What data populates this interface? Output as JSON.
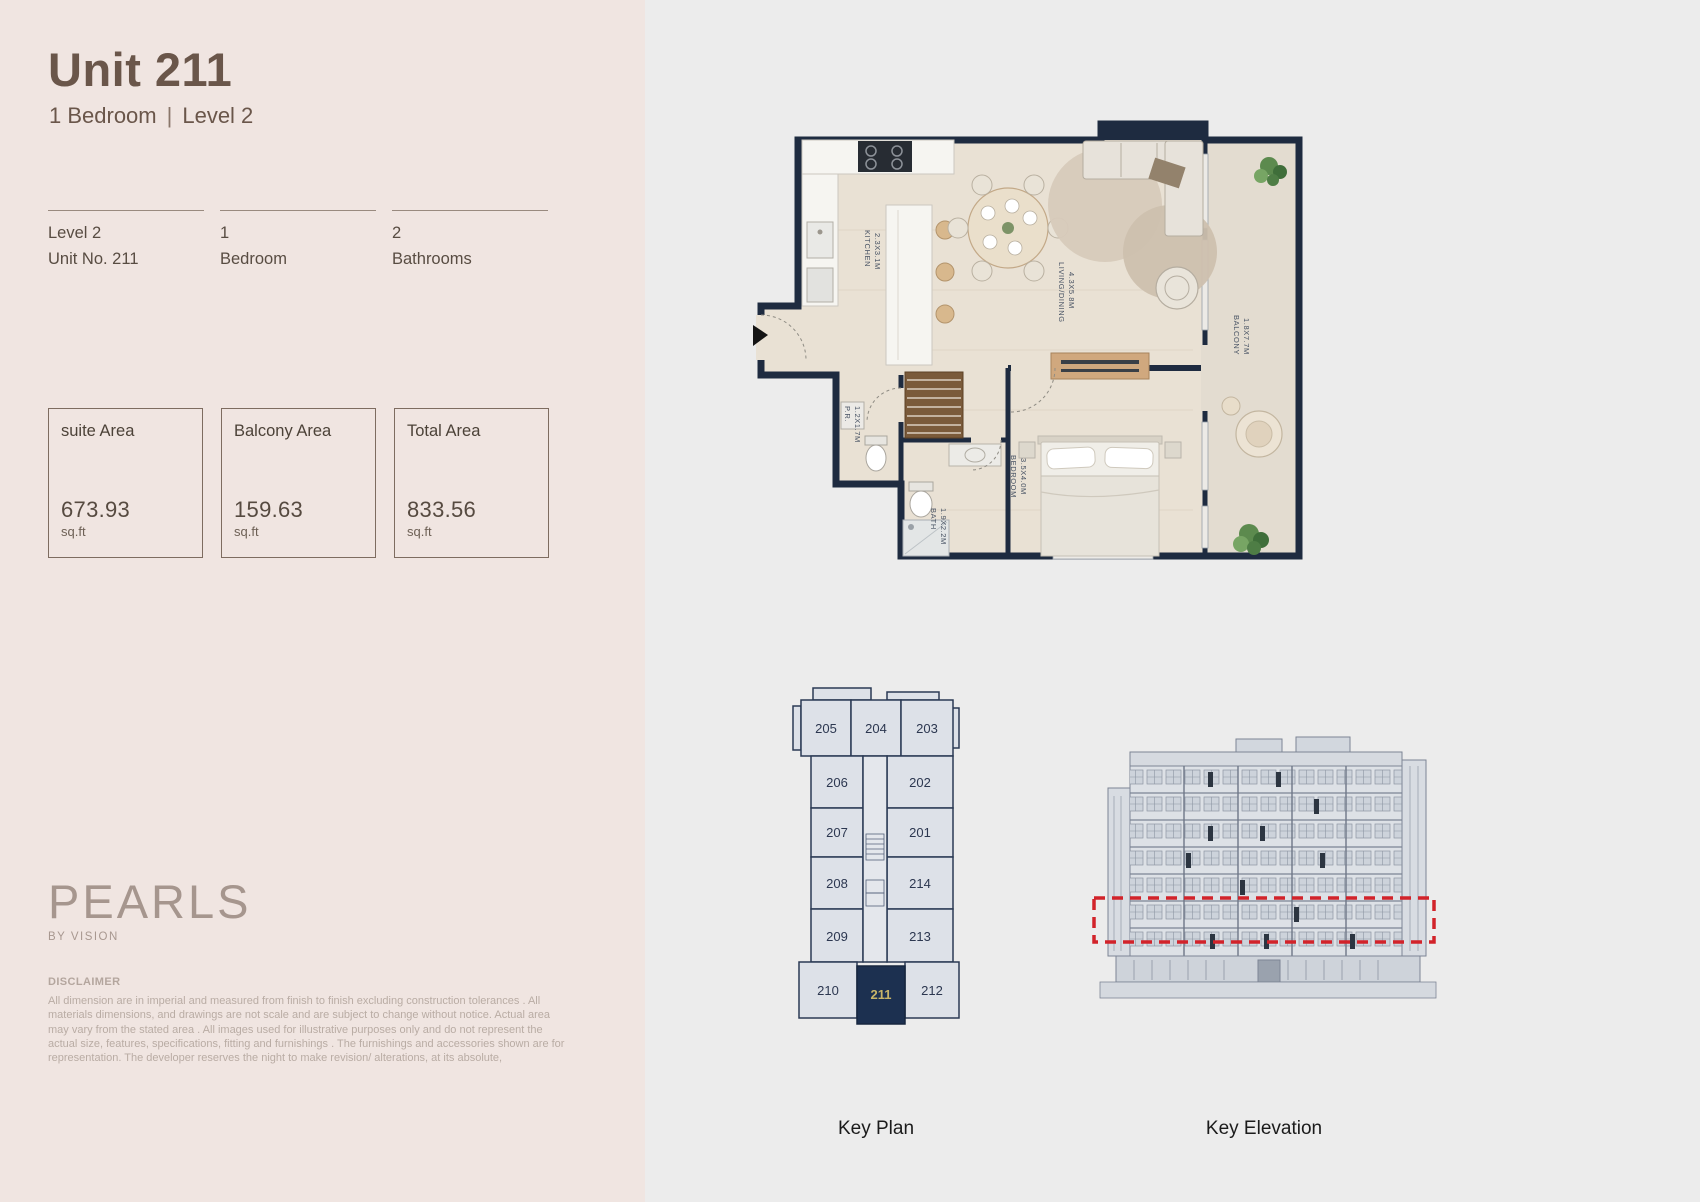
{
  "header": {
    "title": "Unit 211",
    "bedroom": "1 Bedroom",
    "sep": "|",
    "level": "Level 2"
  },
  "specs": [
    {
      "line1": "Level 2",
      "line2": "Unit No. 211"
    },
    {
      "line1": "1",
      "line2": "Bedroom"
    },
    {
      "line1": "2",
      "line2": "Bathrooms"
    }
  ],
  "areas": [
    {
      "label": "suite Area",
      "value": "673.93",
      "unit": "sq.ft"
    },
    {
      "label": "Balcony Area",
      "value": "159.63",
      "unit": "sq.ft"
    },
    {
      "label": "Total Area",
      "value": "833.56",
      "unit": "sq.ft"
    }
  ],
  "brand": {
    "name": "PEARLS",
    "tagline": "BY VISION"
  },
  "disclaimer": {
    "heading": "DISCLAIMER",
    "body": "All dimension are in imperial and measured from finish to finish excluding construction tolerances . All materials dimensions, and drawings are not scale and are subject to change without notice. Actual area may vary from the stated area . All images used for illustrative purposes only and do not represent the actual size, features, specifications, fitting and furnishings . The furnishings and accessories shown are for representation. The developer reserves the night to make revision/ alterations, at its absolute,"
  },
  "floorplan": {
    "kitchen": {
      "name": "KITCHEN",
      "dims": "2.3X3.1M"
    },
    "living": {
      "name": "LIVING/DINING",
      "dims": "4.3X5.8M"
    },
    "balcony": {
      "name": "BALCONY",
      "dims": "1.8X7.7M"
    },
    "bedroom": {
      "name": "BEDROOM",
      "dims": "3.5X4.0M"
    },
    "bath": {
      "name": "BATH",
      "dims": "1.9X2.2M"
    },
    "pr": {
      "name": "P.R.",
      "dims": "1.2X1.7M"
    }
  },
  "keyplan": {
    "caption": "Key Plan",
    "top": [
      "205",
      "204",
      "203"
    ],
    "left": [
      "206",
      "207",
      "208",
      "209"
    ],
    "right": [
      "202",
      "201",
      "214",
      "213"
    ],
    "bottom": [
      "210",
      "211",
      "212"
    ],
    "highlight_unit": "211",
    "highlight_color": "#1c3050",
    "highlight_text_color": "#c8b568"
  },
  "elevation": {
    "caption": "Key Elevation",
    "highlight_color": "#d2232a"
  },
  "colors": {
    "panel_bg": "#f0e5e1",
    "canvas_bg": "#ececec",
    "title": "#6a564a",
    "wall": "#1e2b40"
  }
}
